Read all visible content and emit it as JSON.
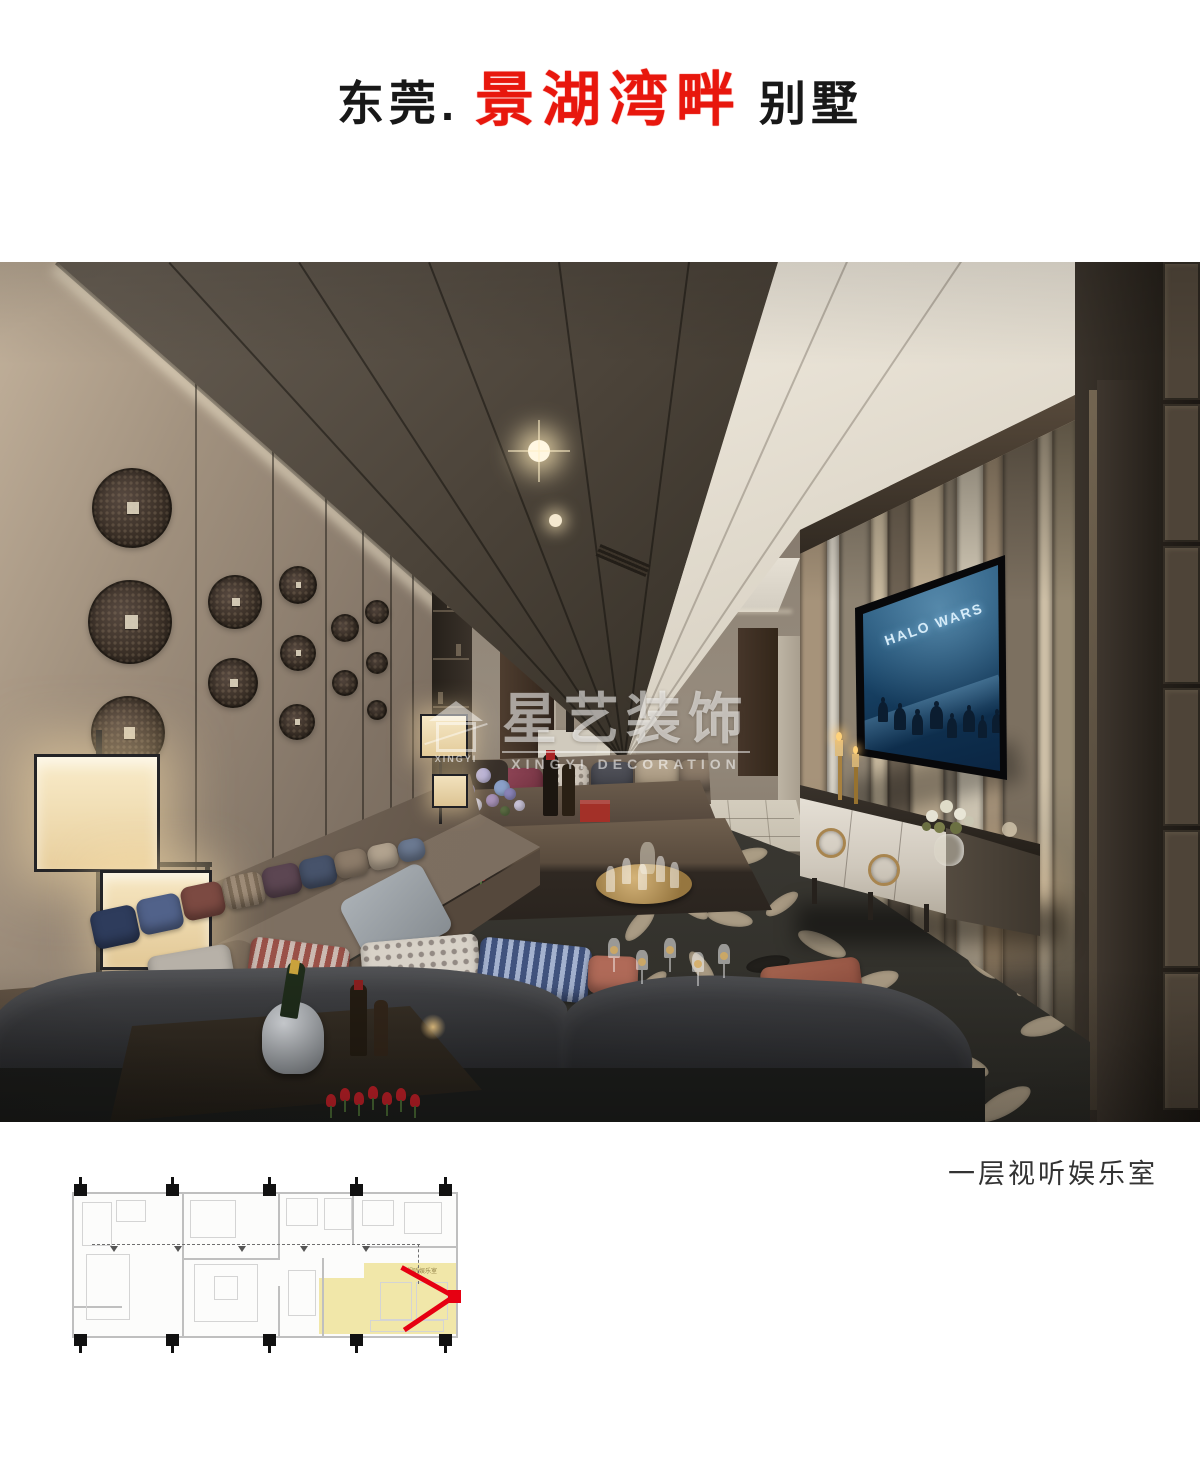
{
  "header": {
    "prefix": "东莞.",
    "brand": "景湖湾畔",
    "suffix": "别墅"
  },
  "photo": {
    "tv_title": "HALO WARS",
    "watermark": {
      "logo_text": "XINGYI",
      "brand_cn": "星艺装饰",
      "brand_en": "XINGYI DECORATION"
    }
  },
  "caption": "一层视听娱乐室",
  "floor_plan": {
    "highlight_room_label": "视听娱乐室"
  },
  "colors": {
    "brand_red": "#e8170d",
    "arrow_red": "#e60012",
    "plan_highlight": "#efe5ae",
    "caption_text": "#333333",
    "watermark_white": "rgba(255,255,255,0.55)",
    "tv_screen_blue": "#1c4a6e",
    "wall_tan": "#a2927f",
    "carpet_dark": "#34322d"
  }
}
